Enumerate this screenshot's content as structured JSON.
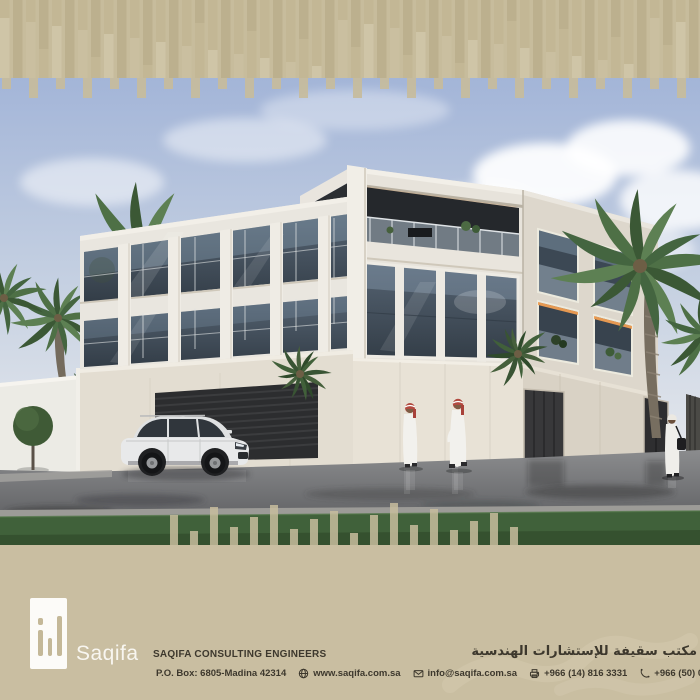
{
  "footer": {
    "logo_text": "Saqifa",
    "company_name_en": "SAQIFA CONSULTING ENGINEERS",
    "company_name_ar": "مكتب سقيفة للإستشارات الهندسية",
    "po_box": "P.O. Box: 6805-Madina 42314",
    "website": "www.saqifa.com.sa",
    "email": "info@saqifa.com.sa",
    "fax": "+966 (14) 816 3331",
    "phone": "+966 (50) 027 5888"
  },
  "icons": {
    "website": "globe-icon",
    "email": "envelope-icon",
    "fax": "fax-icon",
    "phone": "phone-icon"
  },
  "colors": {
    "band_beige": "#c7bc9c",
    "footer_band": "#c9bea1",
    "text_dark": "#3d382d",
    "logo_bars": "#c4b898",
    "sky_blue": "#a5b7d8",
    "glass_dark": "#44505c",
    "accent_orange": "#f0a257",
    "grass_green": "#40613a"
  }
}
